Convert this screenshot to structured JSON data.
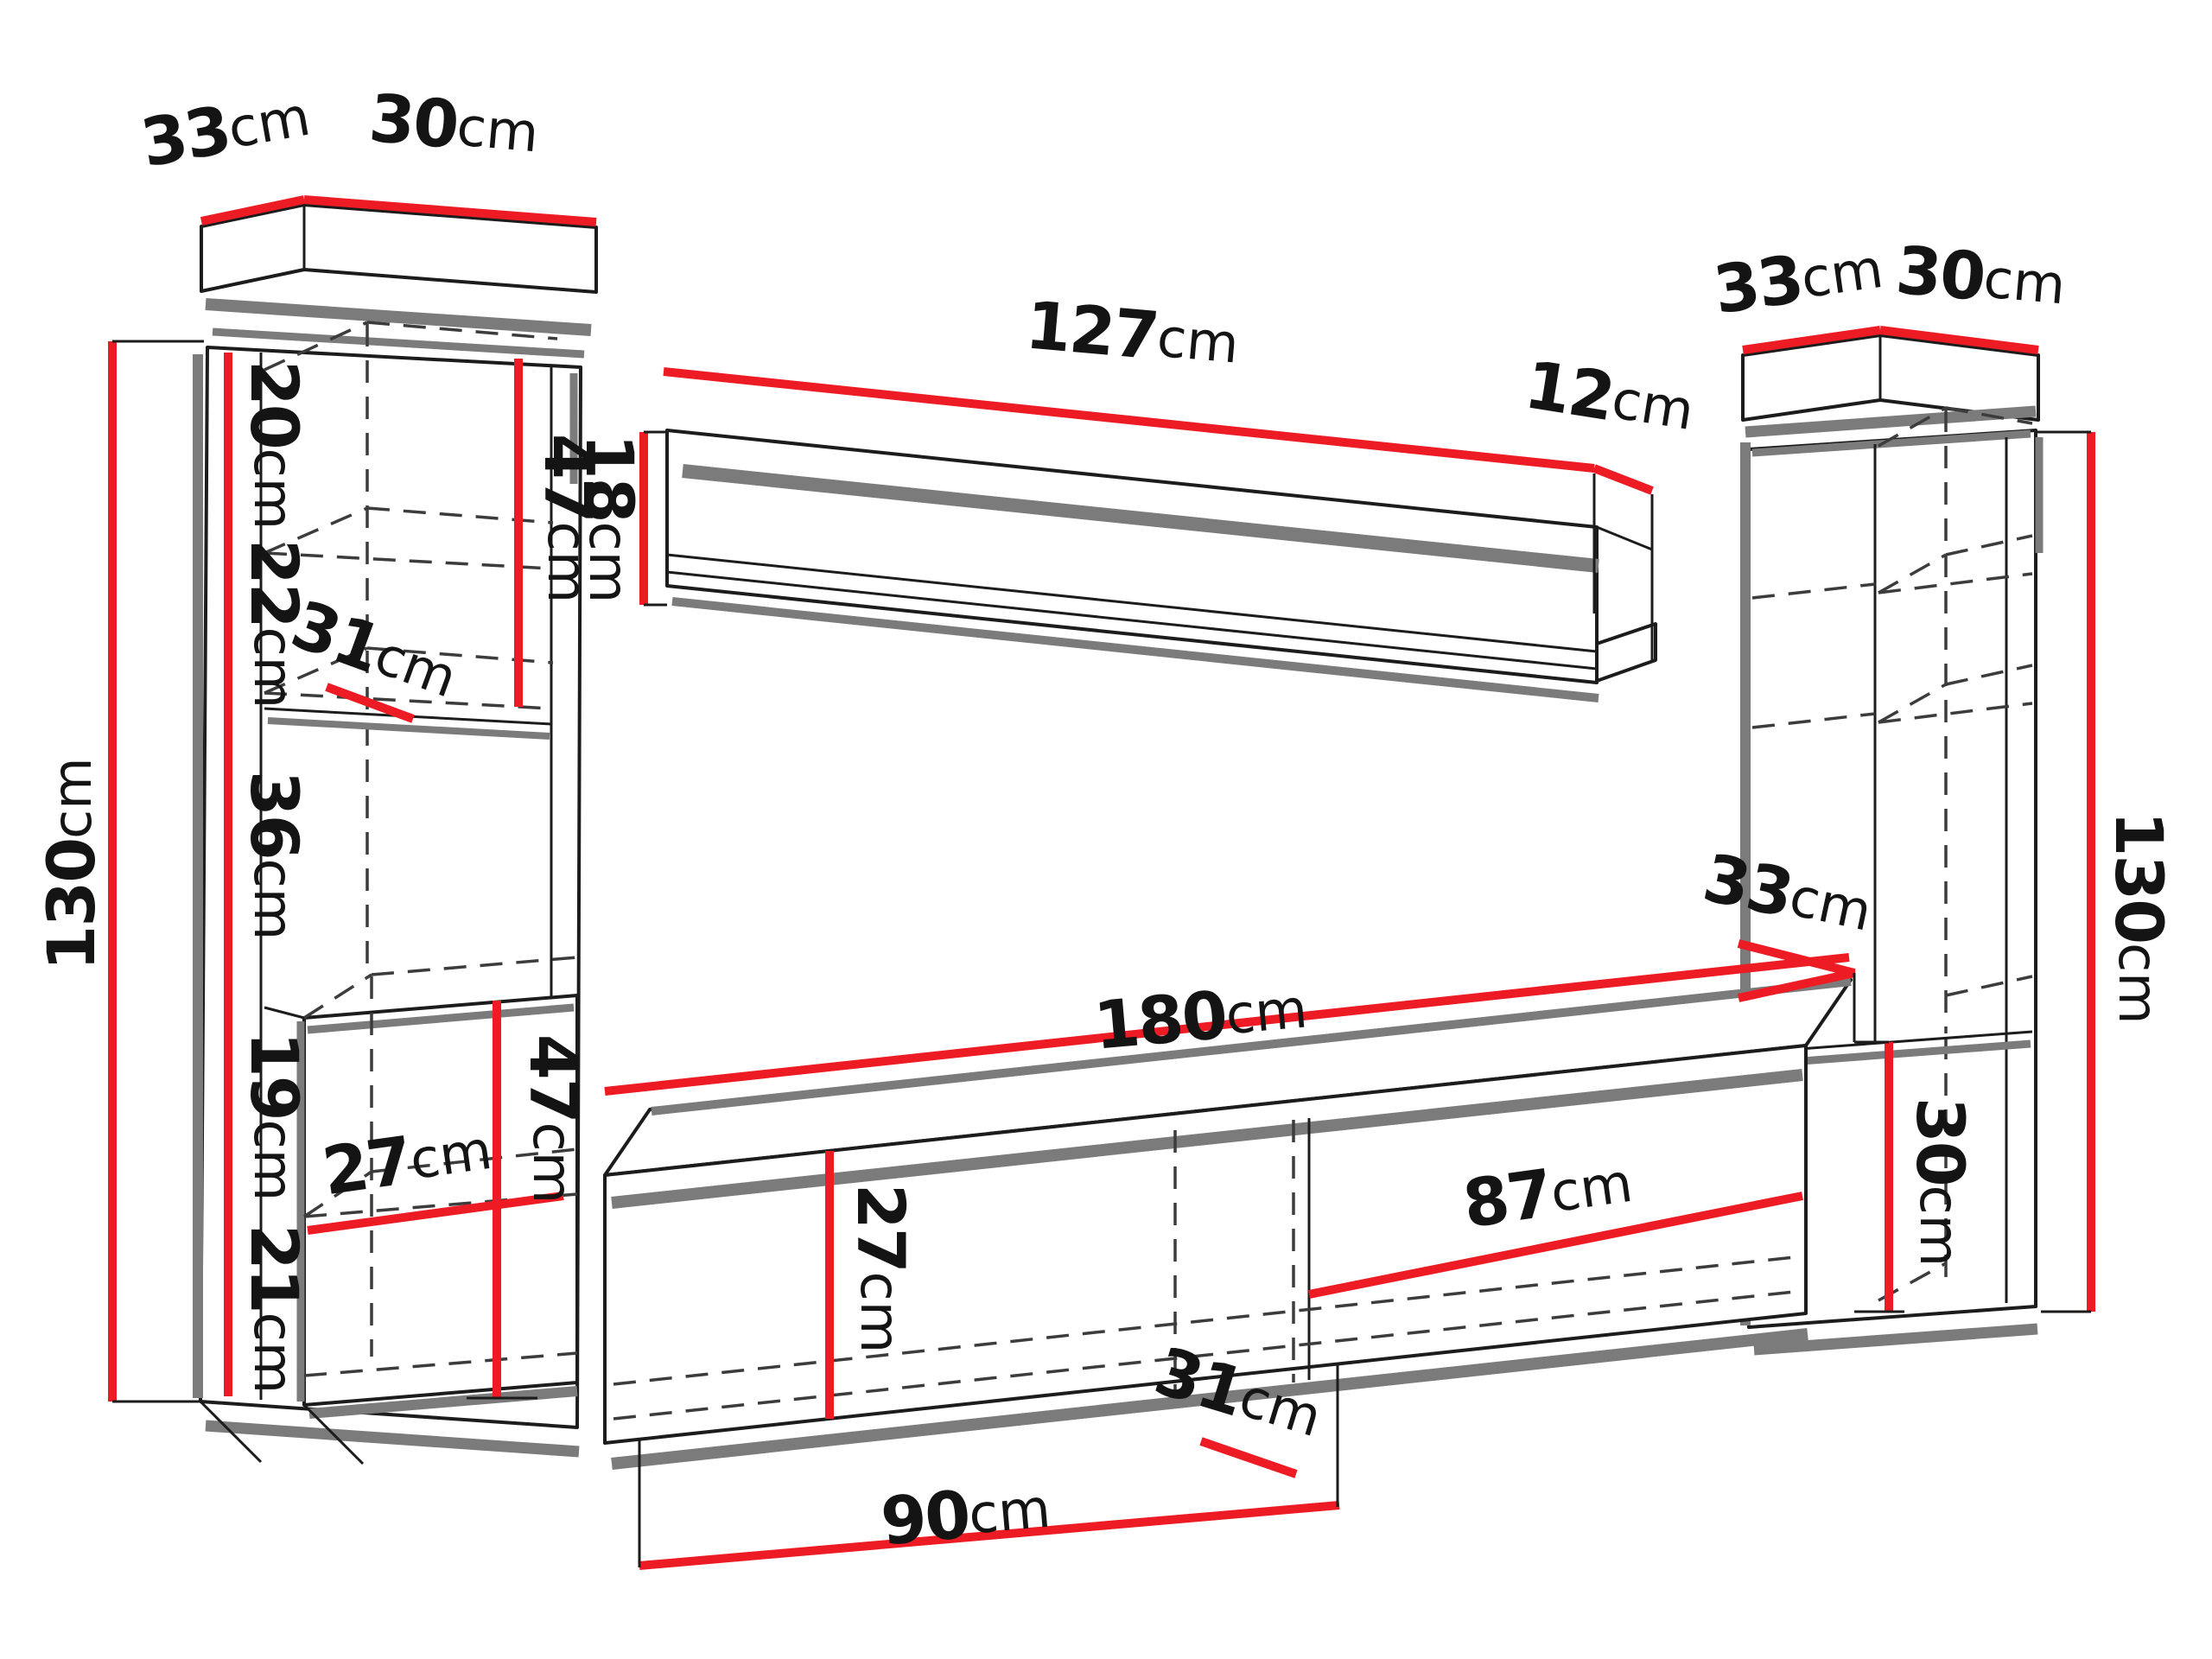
{
  "diagram": {
    "type": "furniture-dimension-diagram",
    "subject": "wall unit: two tall cabinets, wall shelf, TV stand",
    "unit": "cm",
    "colors": {
      "dimension_line": "#ed1c24",
      "outline": "#1c1c1c",
      "shadow": "#7b7b7b",
      "hidden_edge": "#3c3c3c",
      "background": "#ffffff"
    }
  },
  "labels": {
    "lc_top_depth": {
      "num": "33",
      "unit": "cm"
    },
    "lc_top_width": {
      "num": "30",
      "unit": "cm"
    },
    "lc_height": {
      "num": "130",
      "unit": "cm"
    },
    "lc_cell1": {
      "num": "20",
      "unit": "cm"
    },
    "lc_cell2": {
      "num": "22",
      "unit": "cm"
    },
    "lc_shelf_depth": {
      "num": "31",
      "unit": "cm"
    },
    "lc_cell3": {
      "num": "36",
      "unit": "cm"
    },
    "lc_cell4": {
      "num": "19",
      "unit": "cm"
    },
    "lc_inner_width": {
      "num": "27",
      "unit": "cm"
    },
    "lc_cell5": {
      "num": "21",
      "unit": "cm"
    },
    "lc_upper_section": {
      "num": "47",
      "unit": "cm"
    },
    "lc_lower_section": {
      "num": "47",
      "unit": "cm"
    },
    "ws_width": {
      "num": "127",
      "unit": "cm"
    },
    "ws_depth": {
      "num": "12",
      "unit": "cm"
    },
    "ws_height": {
      "num": "18",
      "unit": "cm"
    },
    "rc_top_depth": {
      "num": "33",
      "unit": "cm"
    },
    "rc_top_width": {
      "num": "30",
      "unit": "cm"
    },
    "rc_height": {
      "num": "130",
      "unit": "cm"
    },
    "rc_niche_depth": {
      "num": "33",
      "unit": "cm"
    },
    "rc_niche_height": {
      "num": "30",
      "unit": "cm"
    },
    "tv_width": {
      "num": "180",
      "unit": "cm"
    },
    "tv_front_height": {
      "num": "27",
      "unit": "cm"
    },
    "tv_inner_depth": {
      "num": "31",
      "unit": "cm"
    },
    "tv_right_section": {
      "num": "87",
      "unit": "cm"
    },
    "tv_left_section": {
      "num": "90",
      "unit": "cm"
    }
  }
}
